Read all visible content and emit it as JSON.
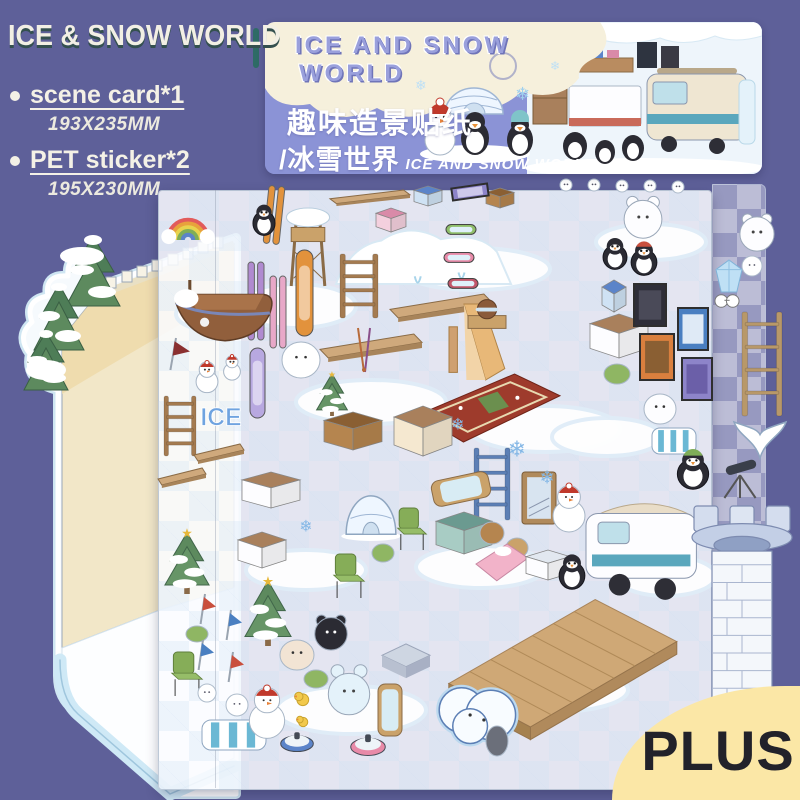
{
  "colors": {
    "bg": "#5e6099",
    "header_blue": "#8b93d6",
    "cream": "#f6f0dc",
    "plus_bg": "#fbe7a6",
    "plus_text": "#22222a",
    "card_wall": "#f2e7c8",
    "ice_blue": "#cfe9f6",
    "title_text": "#f2efe4",
    "title_shadow": "#34504f",
    "bubble_purple": "#9aa0dc"
  },
  "title_block": {
    "title": "ICE & SNOW WORLD",
    "items": [
      {
        "label": "scene card*1",
        "size": "193X235MM"
      },
      {
        "label": "PET sticker*2",
        "size": "195X230MM"
      }
    ]
  },
  "header_card": {
    "bubble_line1": "ICE AND SNOW",
    "bubble_line2": "WORLD",
    "cn_title": "趣味造景贴纸",
    "cn_subtitle": "/冰雪世界",
    "en_subtitle": "ICE AND SNOW WORLD"
  },
  "plus_badge": {
    "label": "PLUS"
  },
  "sheet": {
    "stickers": [
      {
        "t": "snowpatch",
        "x": 176,
        "y": 296,
        "w": 90,
        "h": 36
      },
      {
        "t": "snowpatch",
        "x": 236,
        "y": 284,
        "w": 120,
        "h": 44
      },
      {
        "t": "snowpatch",
        "x": 400,
        "y": 248,
        "w": 150,
        "h": 42
      },
      {
        "t": "snowpatch",
        "x": 296,
        "y": 380,
        "w": 150,
        "h": 44
      },
      {
        "t": "snowpatch",
        "x": 470,
        "y": 406,
        "w": 150,
        "h": 46
      },
      {
        "t": "snowpatch",
        "x": 246,
        "y": 550,
        "w": 120,
        "h": 40
      },
      {
        "t": "snowpatch",
        "x": 416,
        "y": 546,
        "w": 130,
        "h": 42
      },
      {
        "t": "snowpatch",
        "x": 552,
        "y": 418,
        "w": 110,
        "h": 38
      },
      {
        "t": "snowpatch",
        "x": 276,
        "y": 686,
        "w": 150,
        "h": 48
      },
      {
        "t": "snowpatch",
        "x": 478,
        "y": 668,
        "w": 150,
        "h": 44
      },
      {
        "t": "snowpatch",
        "x": 596,
        "y": 224,
        "w": 110,
        "h": 36
      },
      {
        "t": "snowpatch",
        "x": 616,
        "y": 556,
        "w": 100,
        "h": 40
      },
      {
        "t": "mound",
        "x": 336,
        "y": 220,
        "w": 175,
        "h": 64
      },
      {
        "t": "circle",
        "x": 560,
        "y": 179,
        "w": 12,
        "h": 12
      },
      {
        "t": "circle",
        "x": 588,
        "y": 179,
        "w": 12,
        "h": 12
      },
      {
        "t": "circle",
        "x": 616,
        "y": 180,
        "w": 12,
        "h": 12
      },
      {
        "t": "circle",
        "x": 644,
        "y": 180,
        "w": 12,
        "h": 12
      },
      {
        "t": "circle",
        "x": 672,
        "y": 181,
        "w": 12,
        "h": 12
      },
      {
        "t": "ski",
        "x": 266,
        "y": 186,
        "w": 16,
        "h": 58,
        "c": "#e2923c",
        "r": 6
      },
      {
        "t": "plank",
        "x": 330,
        "y": 190,
        "w": 80,
        "h": 16
      },
      {
        "t": "box",
        "x": 376,
        "y": 208,
        "w": 30,
        "h": 24,
        "c": "#f4d0de",
        "c2": "#d98aa8"
      },
      {
        "t": "box",
        "x": 414,
        "y": 186,
        "w": 28,
        "h": 20,
        "c": "#cfe2f4",
        "c2": "#5b84c9"
      },
      {
        "t": "box",
        "x": 486,
        "y": 188,
        "w": 28,
        "h": 20,
        "c": "#b5854f",
        "c2": "#8a5f33"
      },
      {
        "t": "frame",
        "x": 452,
        "y": 186,
        "w": 36,
        "h": 12,
        "c": "#8d84c9",
        "c2": "#cdc8ea",
        "r": -8
      },
      {
        "t": "watchtower",
        "x": 284,
        "y": 208,
        "w": 48,
        "h": 78
      },
      {
        "t": "penguin",
        "x": 252,
        "y": 204,
        "w": 24,
        "h": 32
      },
      {
        "t": "ladder",
        "x": 340,
        "y": 254,
        "w": 38,
        "h": 64,
        "c": "#a47b50"
      },
      {
        "t": "ski",
        "x": 248,
        "y": 262,
        "w": 16,
        "h": 78,
        "c": "#b08ad0"
      },
      {
        "t": "ski",
        "x": 270,
        "y": 276,
        "w": 16,
        "h": 72,
        "c": "#e8a8c8"
      },
      {
        "t": "snowboard",
        "x": 296,
        "y": 250,
        "w": 17,
        "h": 86,
        "c": "#e2923c"
      },
      {
        "t": "snowboard",
        "x": 250,
        "y": 348,
        "w": 15,
        "h": 70,
        "c": "#b8a8e0"
      },
      {
        "t": "plank",
        "x": 390,
        "y": 294,
        "w": 102,
        "h": 28
      },
      {
        "t": "plank",
        "x": 320,
        "y": 334,
        "w": 102,
        "h": 28
      },
      {
        "t": "slide",
        "x": 446,
        "y": 304,
        "w": 60,
        "h": 76
      },
      {
        "t": "goggles",
        "x": 446,
        "y": 220,
        "w": 30,
        "h": 18,
        "c": "#8fbf6a"
      },
      {
        "t": "goggles",
        "x": 444,
        "y": 248,
        "w": 30,
        "h": 18,
        "c": "#e88aa8"
      },
      {
        "t": "goggles",
        "x": 448,
        "y": 274,
        "w": 30,
        "h": 18,
        "c": "#c2566a"
      },
      {
        "t": "helmet",
        "x": 468,
        "y": 298,
        "w": 38,
        "h": 32
      },
      {
        "t": "blob",
        "x": 282,
        "y": 342,
        "w": 38,
        "h": 36,
        "c": "#ffffff",
        "f": 1
      },
      {
        "t": "tree",
        "x": 316,
        "y": 372,
        "w": 32,
        "h": 44
      },
      {
        "t": "poles",
        "x": 354,
        "y": 328,
        "w": 20,
        "h": 44
      },
      {
        "t": "rainbow",
        "x": 164,
        "y": 206,
        "w": 48,
        "h": 34
      },
      {
        "t": "ship",
        "x": 174,
        "y": 280,
        "w": 102,
        "h": 66
      },
      {
        "t": "flag",
        "x": 162,
        "y": 338,
        "w": 28,
        "h": 32,
        "c": "#8a3030"
      },
      {
        "t": "snowman",
        "x": 194,
        "y": 360,
        "w": 26,
        "h": 32
      },
      {
        "t": "snowman",
        "x": 222,
        "y": 354,
        "w": 20,
        "h": 26
      },
      {
        "t": "ladder",
        "x": 164,
        "y": 396,
        "w": 32,
        "h": 60,
        "c": "#a47b50"
      },
      {
        "t": "icetext",
        "x": 200,
        "y": 404,
        "w": 42,
        "h": 26,
        "label": "ICE"
      },
      {
        "t": "plank",
        "x": 194,
        "y": 444,
        "w": 50,
        "h": 20
      },
      {
        "t": "plank",
        "x": 158,
        "y": 468,
        "w": 48,
        "h": 20
      },
      {
        "t": "rug",
        "x": 418,
        "y": 374,
        "w": 142,
        "h": 68
      },
      {
        "t": "ladder",
        "x": 474,
        "y": 448,
        "w": 36,
        "h": 72,
        "c": "#5c7fb5"
      },
      {
        "t": "door",
        "x": 522,
        "y": 472,
        "w": 34,
        "h": 52
      },
      {
        "t": "snowman",
        "x": 550,
        "y": 482,
        "w": 38,
        "h": 50
      },
      {
        "t": "mirror",
        "x": 432,
        "y": 476,
        "w": 58,
        "h": 26,
        "r": -12
      },
      {
        "t": "box",
        "x": 436,
        "y": 512,
        "w": 56,
        "h": 42,
        "c": "#a8ccc4",
        "c2": "#6b9a90"
      },
      {
        "t": "blob",
        "x": 480,
        "y": 522,
        "w": 24,
        "h": 22,
        "c": "#b5854f"
      },
      {
        "t": "blob",
        "x": 506,
        "y": 538,
        "w": 22,
        "h": 20,
        "c": "#caa26a"
      },
      {
        "t": "bed",
        "x": 476,
        "y": 544,
        "w": 52,
        "h": 40
      },
      {
        "t": "box",
        "x": 526,
        "y": 550,
        "w": 44,
        "h": 30,
        "c": "#fdfdff",
        "c2": "#e2e8f0"
      },
      {
        "t": "box",
        "x": 242,
        "y": 472,
        "w": 58,
        "h": 36,
        "c": "#fdfdff",
        "c2": "#a9805c"
      },
      {
        "t": "box",
        "x": 238,
        "y": 532,
        "w": 48,
        "h": 36,
        "c": "#fdfdff",
        "c2": "#a9805c"
      },
      {
        "t": "box",
        "x": 324,
        "y": 412,
        "w": 58,
        "h": 38,
        "c": "#b5854f",
        "c2": "#8a5f33"
      },
      {
        "t": "box",
        "x": 394,
        "y": 406,
        "w": 58,
        "h": 50,
        "c": "#f5e8d0",
        "c2": "#a9805c"
      },
      {
        "t": "tree",
        "x": 164,
        "y": 530,
        "w": 46,
        "h": 64
      },
      {
        "t": "tree",
        "x": 244,
        "y": 578,
        "w": 48,
        "h": 68
      },
      {
        "t": "igloo",
        "x": 344,
        "y": 492,
        "w": 54,
        "h": 48
      },
      {
        "t": "chair",
        "x": 396,
        "y": 508,
        "w": 32,
        "h": 42
      },
      {
        "t": "chair",
        "x": 332,
        "y": 554,
        "w": 34,
        "h": 44
      },
      {
        "t": "chair",
        "x": 170,
        "y": 652,
        "w": 34,
        "h": 44
      },
      {
        "t": "blob",
        "x": 372,
        "y": 544,
        "w": 22,
        "h": 18,
        "c": "#8fb663"
      },
      {
        "t": "blob",
        "x": 186,
        "y": 626,
        "w": 22,
        "h": 16,
        "c": "#8fb663"
      },
      {
        "t": "blob",
        "x": 304,
        "y": 670,
        "w": 24,
        "h": 18,
        "c": "#8fb663"
      },
      {
        "t": "blob",
        "x": 604,
        "y": 364,
        "w": 26,
        "h": 20,
        "c": "#8fb663"
      },
      {
        "t": "flag",
        "x": 194,
        "y": 594,
        "w": 22,
        "h": 30,
        "c": "#c94f3d"
      },
      {
        "t": "flag",
        "x": 220,
        "y": 610,
        "w": 22,
        "h": 30,
        "c": "#4a7fc1"
      },
      {
        "t": "flag",
        "x": 192,
        "y": 640,
        "w": 22,
        "h": 30,
        "c": "#4a7fc1"
      },
      {
        "t": "flag",
        "x": 222,
        "y": 652,
        "w": 22,
        "h": 30,
        "c": "#c94f3d"
      },
      {
        "t": "circle",
        "x": 198,
        "y": 684,
        "w": 18,
        "h": 18
      },
      {
        "t": "circle",
        "x": 226,
        "y": 694,
        "w": 22,
        "h": 22
      },
      {
        "t": "stripedbench",
        "x": 202,
        "y": 720,
        "w": 64,
        "h": 30
      },
      {
        "t": "snowman",
        "x": 246,
        "y": 684,
        "w": 42,
        "h": 54
      },
      {
        "t": "duck",
        "x": 294,
        "y": 692,
        "w": 16,
        "h": 14
      },
      {
        "t": "duck",
        "x": 296,
        "y": 716,
        "w": 13,
        "h": 11
      },
      {
        "t": "bear",
        "x": 312,
        "y": 614,
        "w": 38,
        "h": 36,
        "c": "#2b2b33"
      },
      {
        "t": "blob",
        "x": 280,
        "y": 640,
        "w": 34,
        "h": 30,
        "c": "#f2e4d4",
        "f": 1
      },
      {
        "t": "bear",
        "x": 326,
        "y": 660,
        "w": 46,
        "h": 62,
        "c": "#e4f2fa"
      },
      {
        "t": "curling",
        "x": 280,
        "y": 730,
        "w": 34,
        "h": 22,
        "c": "#5b84c9"
      },
      {
        "t": "curling",
        "x": 350,
        "y": 732,
        "w": 36,
        "h": 24,
        "c": "#e88aa8"
      },
      {
        "t": "slab",
        "x": 382,
        "y": 642,
        "w": 48,
        "h": 38
      },
      {
        "t": "mirror",
        "x": 378,
        "y": 684,
        "w": 24,
        "h": 52
      },
      {
        "t": "van",
        "x": 586,
        "y": 494,
        "w": 120,
        "h": 108
      },
      {
        "t": "penguin",
        "x": 558,
        "y": 554,
        "w": 28,
        "h": 36
      },
      {
        "t": "deck",
        "x": 444,
        "y": 594,
        "w": 240,
        "h": 140
      },
      {
        "t": "pond",
        "x": 434,
        "y": 684,
        "w": 86,
        "h": 62
      },
      {
        "t": "blob",
        "x": 486,
        "y": 726,
        "w": 22,
        "h": 30,
        "c": "#6b6f7a"
      },
      {
        "t": "bear",
        "x": 622,
        "y": 194,
        "w": 42,
        "h": 46,
        "c": "#fdfdff"
      },
      {
        "t": "penguin",
        "x": 602,
        "y": 238,
        "w": 26,
        "h": 32
      },
      {
        "t": "penguin",
        "x": 630,
        "y": 242,
        "w": 28,
        "h": 34,
        "c": "#c94f3d"
      },
      {
        "t": "box",
        "x": 602,
        "y": 280,
        "w": 24,
        "h": 32,
        "c": "#cfe2f4",
        "c2": "#5b84c9"
      },
      {
        "t": "box",
        "x": 590,
        "y": 314,
        "w": 58,
        "h": 44,
        "c": "#fdfdff",
        "c2": "#a9805c"
      },
      {
        "t": "frame",
        "x": 634,
        "y": 284,
        "w": 32,
        "h": 42,
        "c": "#2e2e38",
        "c2": "#4a4a58"
      },
      {
        "t": "frame",
        "x": 640,
        "y": 334,
        "w": 34,
        "h": 46,
        "c": "#d97f3e",
        "c2": "#8a5f33"
      },
      {
        "t": "frame",
        "x": 678,
        "y": 308,
        "w": 30,
        "h": 42,
        "c": "#4a7fc1",
        "c2": "#dfeaf6"
      },
      {
        "t": "frame",
        "x": 682,
        "y": 358,
        "w": 30,
        "h": 42,
        "c": "#8d84c9",
        "c2": "#6b5fa8"
      },
      {
        "t": "blob",
        "x": 644,
        "y": 394,
        "w": 32,
        "h": 30,
        "c": "#fdfdff",
        "f": 1
      },
      {
        "t": "stripedbench",
        "x": 652,
        "y": 428,
        "w": 44,
        "h": 26
      },
      {
        "t": "penguin",
        "x": 676,
        "y": 450,
        "w": 34,
        "h": 40,
        "c": "#7fae58"
      },
      {
        "t": "telescope",
        "x": 714,
        "y": 460,
        "w": 52,
        "h": 38
      },
      {
        "t": "crystal",
        "x": 716,
        "y": 260,
        "w": 26,
        "h": 32
      },
      {
        "t": "glasses",
        "x": 714,
        "y": 294,
        "w": 26,
        "h": 14
      },
      {
        "t": "ropeladder",
        "x": 742,
        "y": 312,
        "w": 40,
        "h": 104
      },
      {
        "t": "bear",
        "x": 738,
        "y": 212,
        "w": 38,
        "h": 40,
        "c": "#fdfdff"
      },
      {
        "t": "circle",
        "x": 742,
        "y": 256,
        "w": 20,
        "h": 20
      },
      {
        "t": "whaletail",
        "x": 734,
        "y": 422,
        "w": 52,
        "h": 36
      },
      {
        "t": "snowflake",
        "x": 506,
        "y": 438,
        "w": 22,
        "h": 22
      },
      {
        "t": "snowflake",
        "x": 538,
        "y": 468,
        "w": 18,
        "h": 18
      },
      {
        "t": "snowflake",
        "x": 450,
        "y": 416,
        "w": 16,
        "h": 16
      },
      {
        "t": "snowflake",
        "x": 298,
        "y": 518,
        "w": 16,
        "h": 16
      },
      {
        "t": "tower",
        "x": 692,
        "y": 506,
        "w": 100,
        "h": 196
      }
    ]
  }
}
